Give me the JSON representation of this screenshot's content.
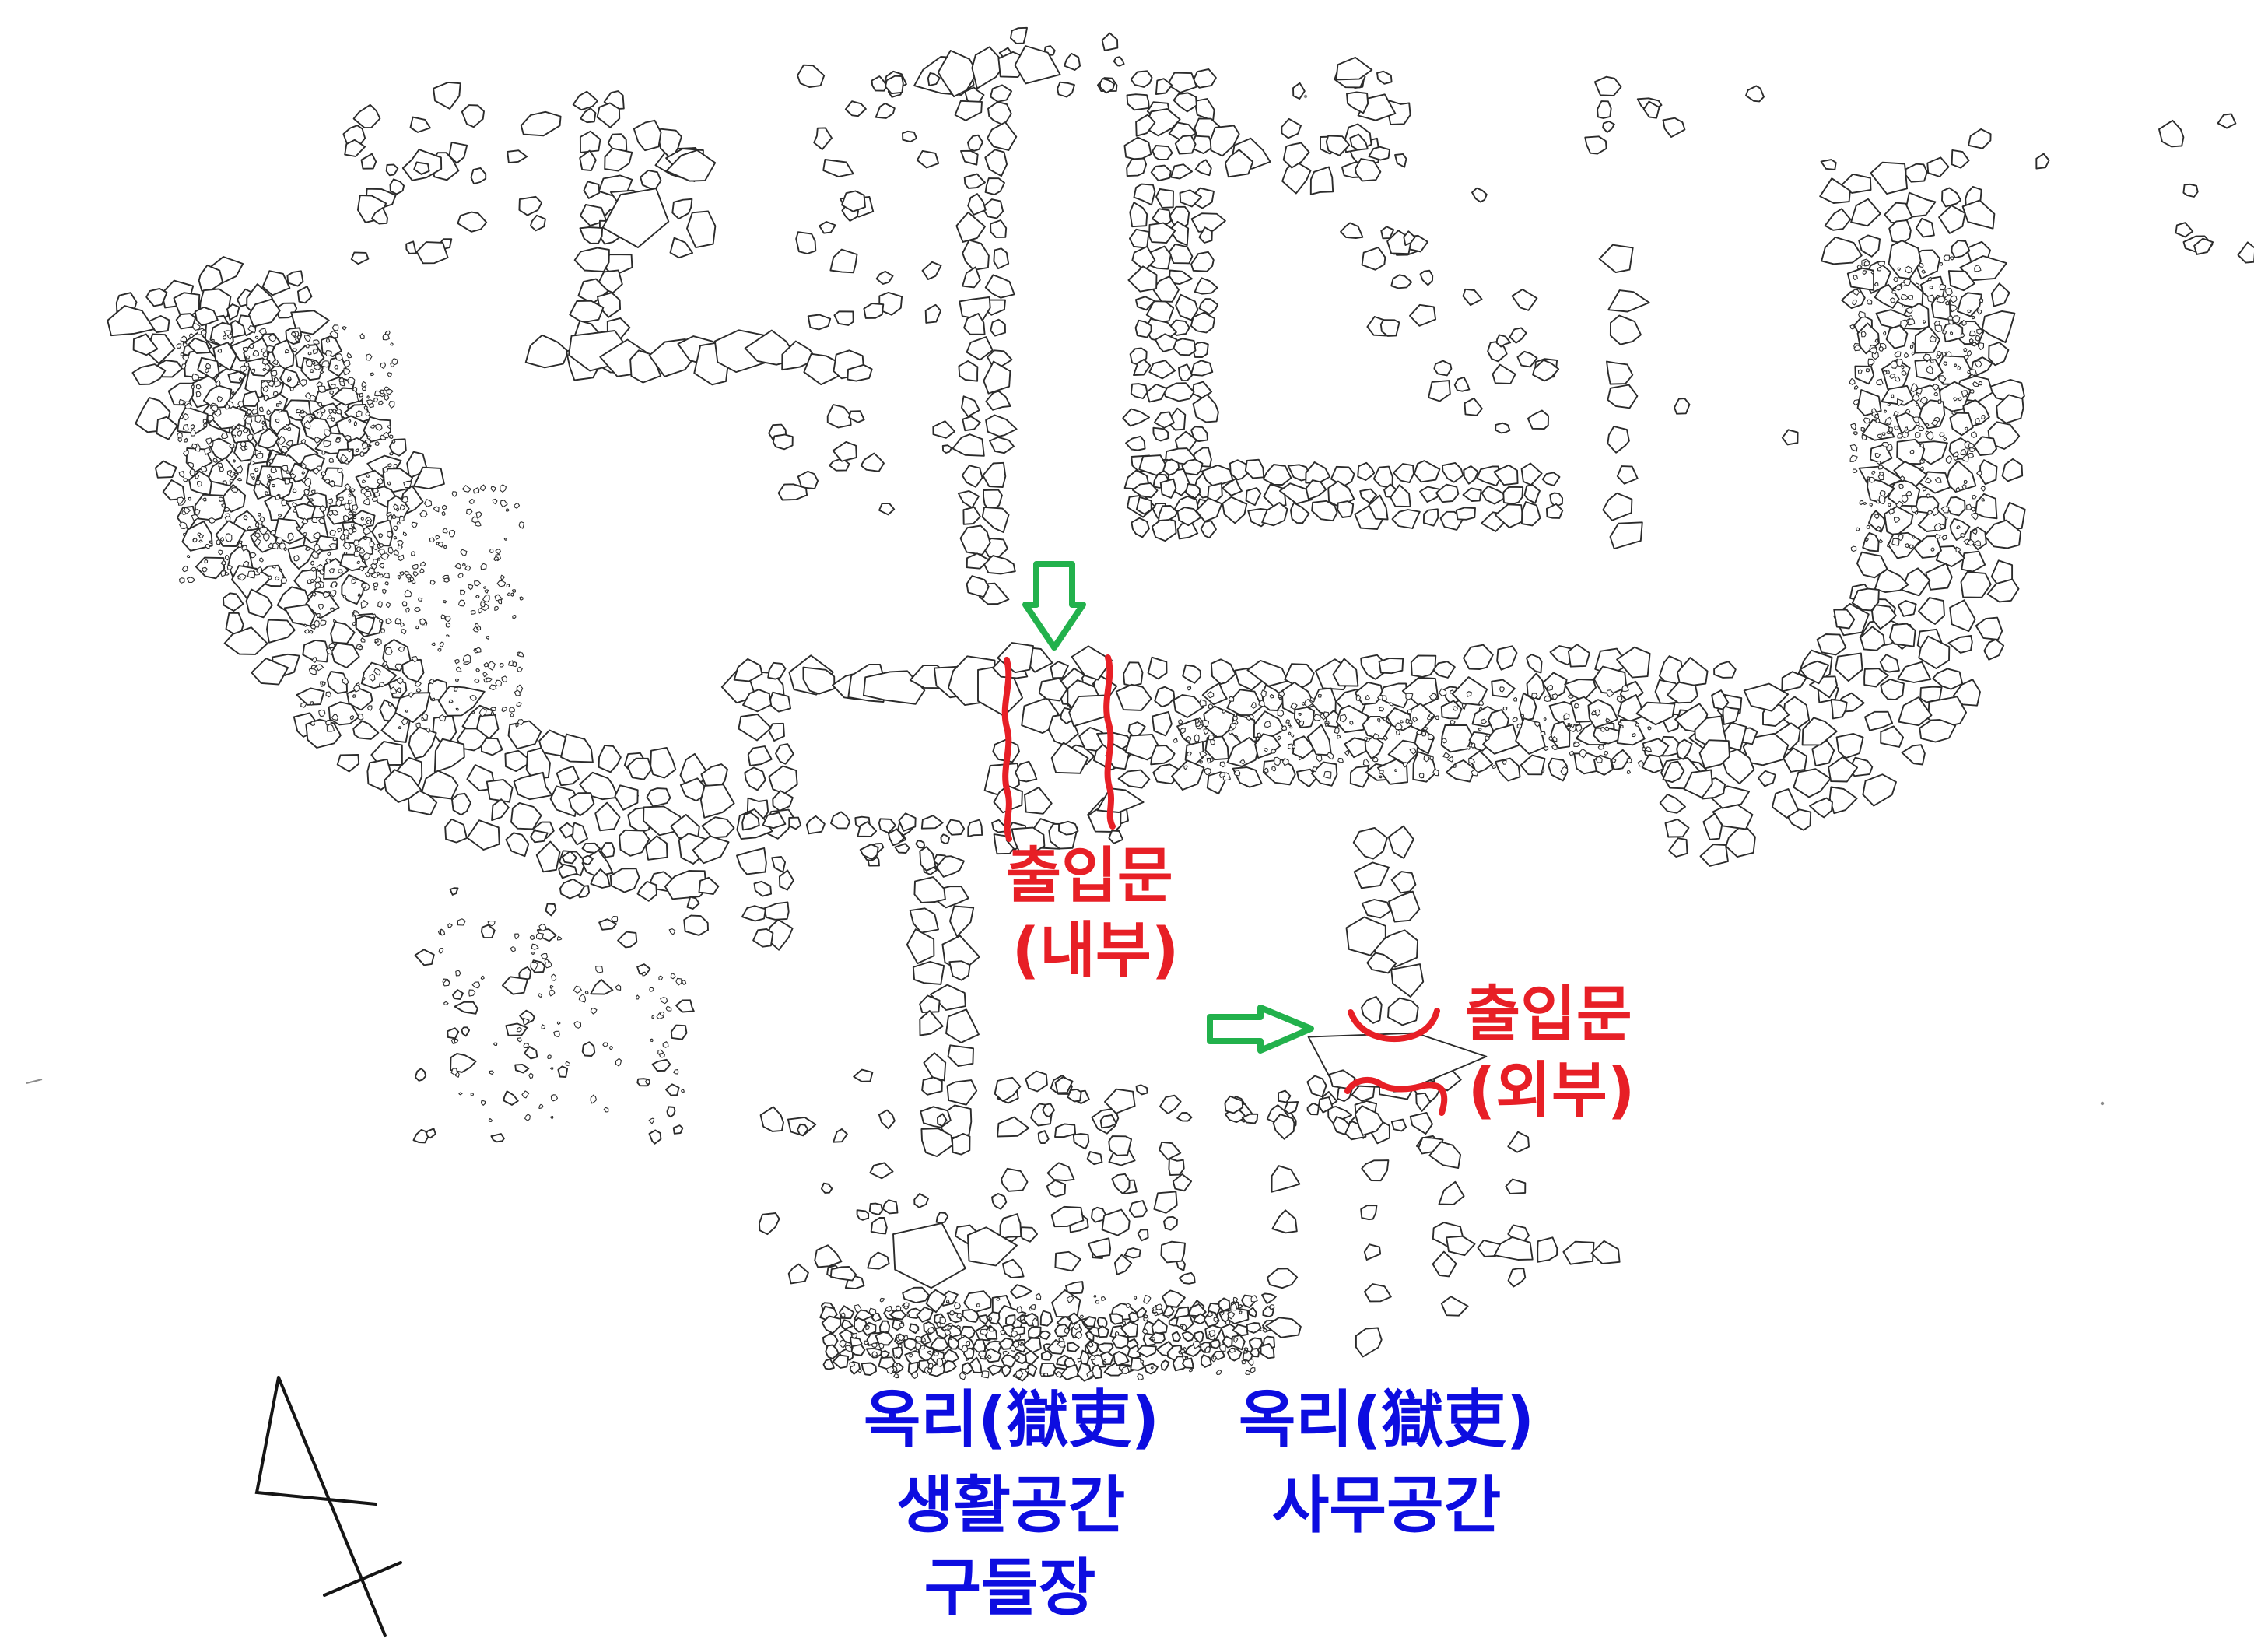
{
  "figure": {
    "type": "archaeological-excavation-plan",
    "background": "#ffffff"
  },
  "colors": {
    "annotation_red": "#e71f26",
    "annotation_blue": "#0d0de0",
    "annotation_green": "#22b14c",
    "line": "#2b2b2b"
  },
  "annotations": {
    "inner_gate": {
      "line1": "출입문",
      "line2": "(내부)"
    },
    "outer_gate": {
      "line1": "출입문",
      "line2": "(외부)"
    },
    "living_space": {
      "line1": "옥리(獄吏)",
      "line2": "생활공간",
      "line3": "구들장"
    },
    "office_space": {
      "line1": "옥리(獄吏)",
      "line2": "사무공간"
    }
  }
}
